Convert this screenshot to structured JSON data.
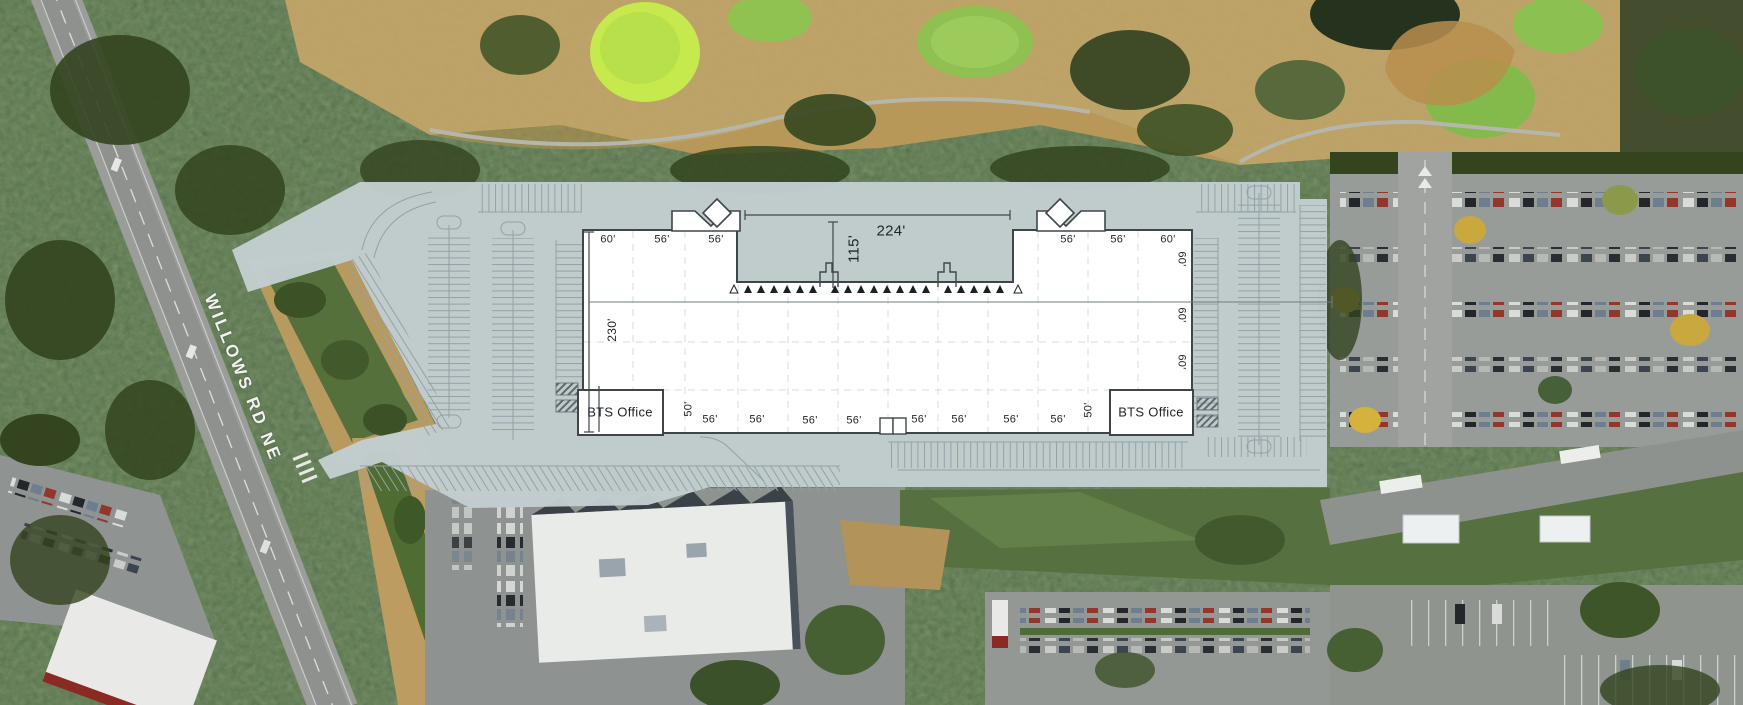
{
  "map": {
    "road_label": "WILLOWS RD NE"
  },
  "site_plan": {
    "offices": {
      "left": "BTS Office",
      "right": "BTS Office"
    },
    "top_bays": [
      "60'",
      "56'",
      "56'",
      "56'",
      "56'",
      "60'"
    ],
    "bottom_bays": [
      "50'",
      "56'",
      "56'",
      "56'",
      "56'",
      "56'",
      "56'",
      "56'",
      "56'",
      "50'"
    ],
    "right_bays": [
      "60'",
      "60'",
      "60'"
    ],
    "building_depth": "230'",
    "truck_court": {
      "width": "224'",
      "depth": "115'"
    },
    "dock_doors": {
      "filled_markers": 19,
      "outlined_markers": 2
    },
    "colors": {
      "site_overlay": "#c3cdd0",
      "building_fill": "#ffffff",
      "plan_outline": "#3f464a",
      "stall_lines": "#93a1a6"
    }
  }
}
